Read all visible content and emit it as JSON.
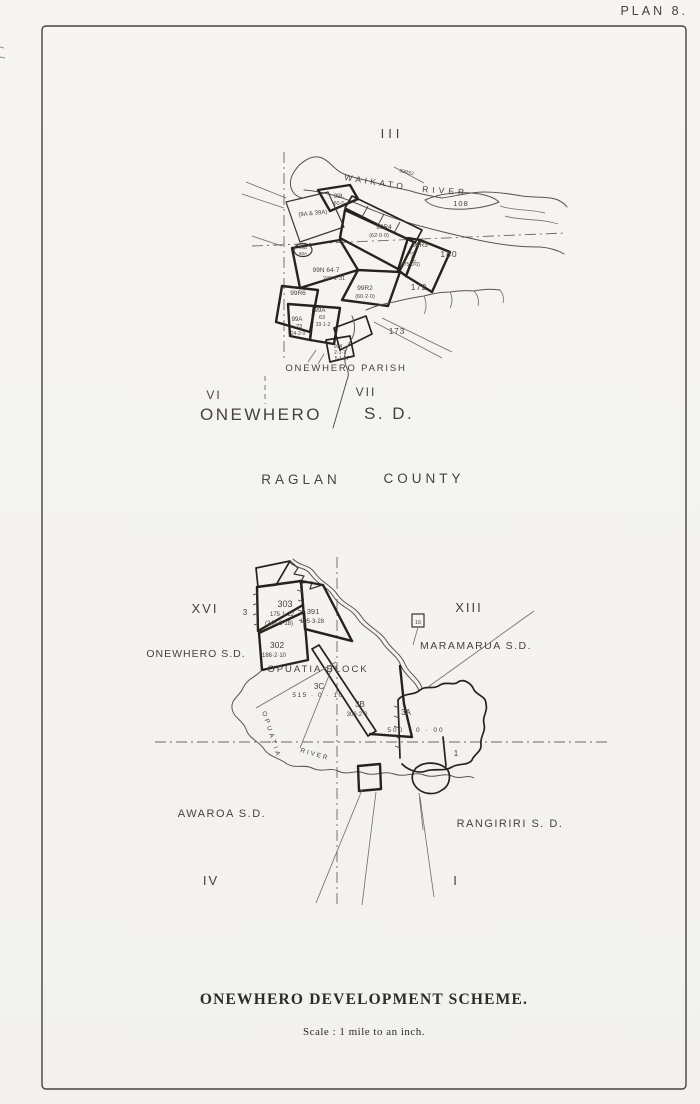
{
  "page": {
    "plan_label": "PLAN 8."
  },
  "upper_map": {
    "numeral_top": "III",
    "river_word1": "WAIKATO",
    "river_word2": "RIVER",
    "labels": [
      {
        "text": "99L"
      },
      {
        "text": "60·0"
      },
      {
        "text": "(9A & 39A)"
      },
      {
        "text": "99R4"
      },
      {
        "text": "(62·0·0)"
      },
      {
        "text": "5·3·0"
      },
      {
        "text": "99R3"
      },
      {
        "text": "(75·0·0)"
      },
      {
        "text": "180"
      },
      {
        "text": "99N 64·7"
      },
      {
        "text": "249·1·31"
      },
      {
        "text": "99R2"
      },
      {
        "text": "(60·2·0)"
      },
      {
        "text": "99R6"
      },
      {
        "text": "99A"
      },
      {
        "text": "63"
      },
      {
        "text": "33·1·2"
      },
      {
        "text": "99A"
      },
      {
        "text": "23"
      },
      {
        "text": "24·2·0"
      },
      {
        "text": "172"
      },
      {
        "text": "173"
      },
      {
        "text": "994"
      },
      {
        "text": "2·3·7"
      },
      {
        "text": "5·1·07"
      },
      {
        "text": "99B"
      },
      {
        "text": "60A"
      },
      {
        "text": "99R52"
      },
      {
        "text": "108"
      }
    ],
    "parish_label": "ONEWHERO PARISH",
    "numeral_left": "VI",
    "numeral_right": "VII",
    "sd_name": "ONEWHERO",
    "sd_suffix": "S. D.",
    "county_word1": "RAGLAN",
    "county_word2": "COUNTY"
  },
  "lower_map": {
    "numeral_left": "XVI",
    "numeral_right": "XIII",
    "numeral_bottom_left": "IV",
    "numeral_bottom_right": "I",
    "sd_left": "ONEWHERO S.D.",
    "sd_right": "MARAMARUA S.D.",
    "sd_bottom_left": "AWAROA S.D.",
    "sd_bottom_right": "RANGIRIRI  S. D.",
    "block_label": "OPUATIA BLOCK",
    "river_word_vertical": "OPUATIA",
    "river_word_horizontal": "RIVER",
    "labels": [
      {
        "text": "303"
      },
      {
        "text": "175·1·12"
      },
      {
        "text": "(242·3·18)"
      },
      {
        "text": "391"
      },
      {
        "text": "195·3·28"
      },
      {
        "text": "302"
      },
      {
        "text": "186·2·10"
      },
      {
        "text": "3C"
      },
      {
        "text": "515 · 0 · 10"
      },
      {
        "text": "3B"
      },
      {
        "text": "306·2·0"
      },
      {
        "text": "3A"
      },
      {
        "text": "500 · 0 · 00"
      },
      {
        "text": "16"
      },
      {
        "text": "3"
      },
      {
        "text": "1"
      }
    ]
  },
  "footer": {
    "title": "ONEWHERO DEVELOPMENT SCHEME.",
    "scale_note": "Scale :  1 mile to an inch."
  }
}
